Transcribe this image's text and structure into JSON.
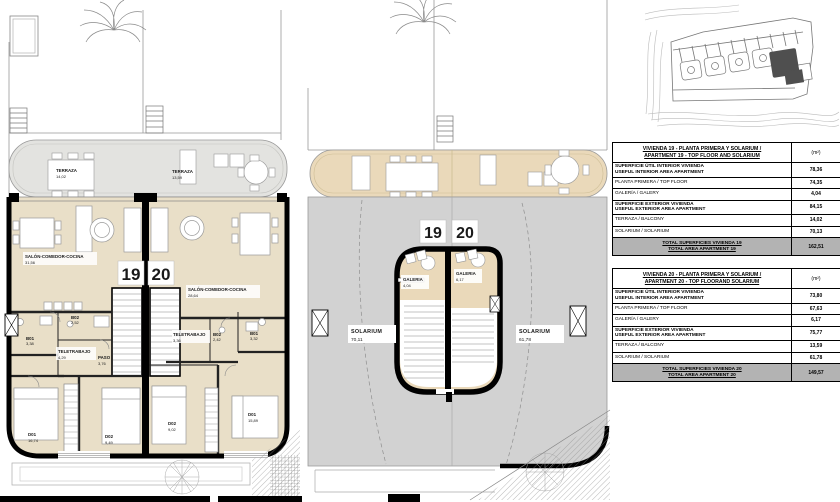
{
  "plans": {
    "top_floor": {
      "number_left": "19",
      "number_right": "20",
      "left": {
        "terraza": {
          "name": "TERRAZA",
          "area": "14,02"
        },
        "salon": {
          "name": "SALÓN-COMEDOR-COCINA",
          "area": "31,56"
        },
        "b01": {
          "name": "B01",
          "area": "3,38"
        },
        "b02": {
          "name": "B02",
          "area": "2,52"
        },
        "teletrabajo": {
          "name": "TELETRABAJO",
          "area": "4,29"
        },
        "paso": {
          "name": "PASO",
          "area": "3,76"
        },
        "d01": {
          "name": "D01",
          "area": "16,74"
        },
        "d02": {
          "name": "D02",
          "area": "9,49"
        }
      },
      "right": {
        "terraza": {
          "name": "TERRAZA",
          "area": "13,59"
        },
        "salon": {
          "name": "SALÓN-COMEDOR-COCINA",
          "area": "28,64"
        },
        "teletrabajo": {
          "name": "TELETRABAJO",
          "area": "3,36"
        },
        "b02": {
          "name": "B02",
          "area": "2,42"
        },
        "b01": {
          "name": "B01",
          "area": "3,32"
        },
        "d02": {
          "name": "D02",
          "area": "9,02"
        },
        "d01": {
          "name": "D01",
          "area": "15,89"
        }
      }
    },
    "solarium_floor": {
      "number_left": "19",
      "number_right": "20",
      "solarium_left": {
        "name": "SOLARIUM",
        "area": "70,11"
      },
      "solarium_right": {
        "name": "SOLARIUM",
        "area": "61,78"
      },
      "galeria_left": {
        "name": "GALERIA",
        "area": "4,04"
      },
      "galeria_right": {
        "name": "GALERIA",
        "area": "6,17"
      }
    }
  },
  "tables": [
    {
      "title_line1": "VIVIENDA 19 - PLANTA PRIMERA Y SOLARIUM /",
      "title_line2": "APARTMENT 19 - TOP FLOOR AND SOLARIUM",
      "unit_header": "(m²)",
      "rows": [
        {
          "label_line1": "SUPERFICIE ÚTIL INTERIOR VIVIENDA",
          "label_line2": "USEFUL INTERIOR AREA APARTMENT",
          "value": "78,36"
        },
        {
          "label_line1": "PLANTA PRIMERA / TOP FLOOR",
          "label_line2": "",
          "value": "74,35"
        },
        {
          "label_line1": "GALERÍA / GALERY",
          "label_line2": "",
          "value": "4,04"
        },
        {
          "label_line1": "SUPERFICIE EXTERIOR VIVIENDA",
          "label_line2": "USEFUL EXTERIOR AREA APARTMENT",
          "value": "84,15"
        },
        {
          "label_line1": "TERRAZA / BALCONY",
          "label_line2": "",
          "value": "14,02"
        },
        {
          "label_line1": "SOLARIUM / SOLARIUM",
          "label_line2": "",
          "value": "70,13"
        }
      ],
      "total_line1": "TOTAL SUPERFICIES VIVIENDA 19",
      "total_line2": "TOTAL AREA APARTMENT 19",
      "total_value": "162,51"
    },
    {
      "title_line1": "VIVIENDA 20 - PLANTA PRIMERA Y SOLARIUM /",
      "title_line2": "APARTMENT 20 - TOP FLOORAND SOLARIUM",
      "unit_header": "(m²)",
      "rows": [
        {
          "label_line1": "SUPERFICIE ÚTIL INTERIOR VIVIENDA",
          "label_line2": "USEFUL INTERIOR AREA APARTMENT",
          "value": "73,80"
        },
        {
          "label_line1": "PLANTA PRIMERA / TOP FLOOR",
          "label_line2": "",
          "value": "67,63"
        },
        {
          "label_line1": "GALERÍA / GALERY",
          "label_line2": "",
          "value": "6,17"
        },
        {
          "label_line1": "SUPERFICIE EXTERIOR VIVIENDA",
          "label_line2": "USEFUL EXTERIOR AREA APARTMENT",
          "value": "75,77"
        },
        {
          "label_line1": "TERRAZA / BALCONY",
          "label_line2": "",
          "value": "13,59"
        },
        {
          "label_line1": "SOLARIUM / SOLARIUM",
          "label_line2": "",
          "value": "61,78"
        }
      ],
      "total_line1": "TOTAL SUPERFICIES VIVIENDA 20",
      "total_line2": "TOTAL AREA APARTMENT 20",
      "total_value": "149,57"
    }
  ]
}
